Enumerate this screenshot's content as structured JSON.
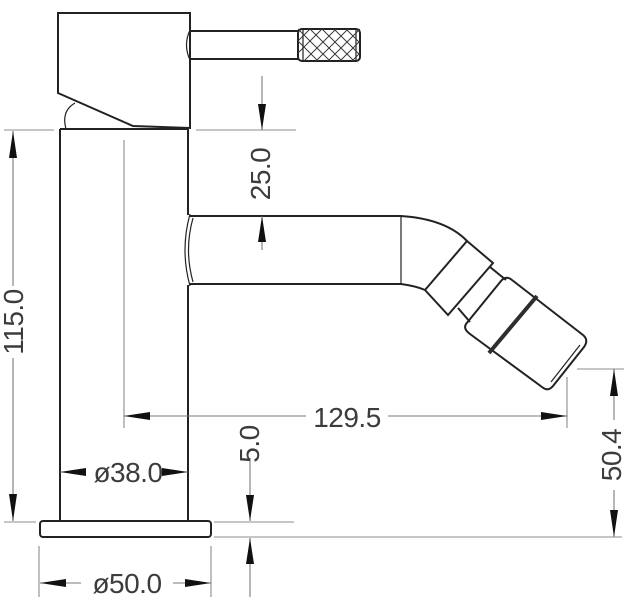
{
  "figure": {
    "type": "technical-dimension-drawing",
    "subject": "single-lever mixer tap, side elevation",
    "background": "#ffffff"
  },
  "style": {
    "outline_color": "#222222",
    "dimension_line_color": "#7a7a7a",
    "reference_line_color": "#8c8c8c",
    "arrow_color": "#111111",
    "text_color": "#3c3c3c"
  },
  "dimensions": {
    "d25": {
      "label": "25.0",
      "value": 25.0,
      "axis": "vertical"
    },
    "d115": {
      "label": "115.0",
      "value": 115.0,
      "axis": "vertical"
    },
    "d129_5": {
      "label": "129.5",
      "value": 129.5,
      "axis": "horizontal"
    },
    "d38": {
      "label": "ø38.0",
      "value": 38.0,
      "axis": "horizontal",
      "diameter": true
    },
    "d5": {
      "label": "5.0",
      "value": 5.0,
      "axis": "vertical"
    },
    "d50": {
      "label": "ø50.0",
      "value": 50.0,
      "axis": "horizontal",
      "diameter": true
    },
    "d50_4": {
      "label": "50.4",
      "value": 50.4,
      "axis": "vertical"
    }
  }
}
